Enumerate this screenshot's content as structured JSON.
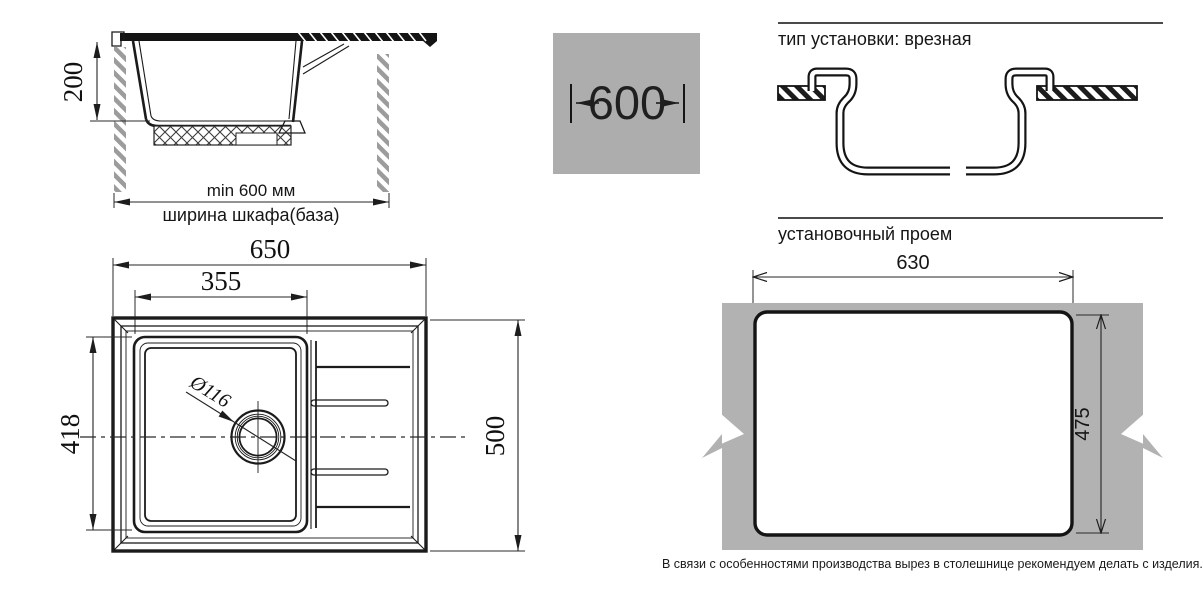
{
  "colors": {
    "line": "#1b1b1b",
    "badge_gray": "#adadad",
    "countertop_gray": "#b2b2b2",
    "hatch_gray": "#9c9c9c"
  },
  "cabinet_section": {
    "depth_dim": "200",
    "min_width_label": "min 600 мм",
    "cabinet_width_label": "ширина шкафа(база)"
  },
  "width_badge": {
    "value": "600"
  },
  "installation_type": {
    "title": "тип установки: врезная"
  },
  "top_view": {
    "overall_width": "650",
    "bowl_width": "355",
    "bowl_depth": "418",
    "overall_depth": "500",
    "drain_diameter": "Ø116"
  },
  "cutout_view": {
    "title": "установочный проем",
    "width": "630",
    "height": "475",
    "note": "В связи с особенностями производства вырез в столешнице рекомендуем делать с изделия."
  }
}
